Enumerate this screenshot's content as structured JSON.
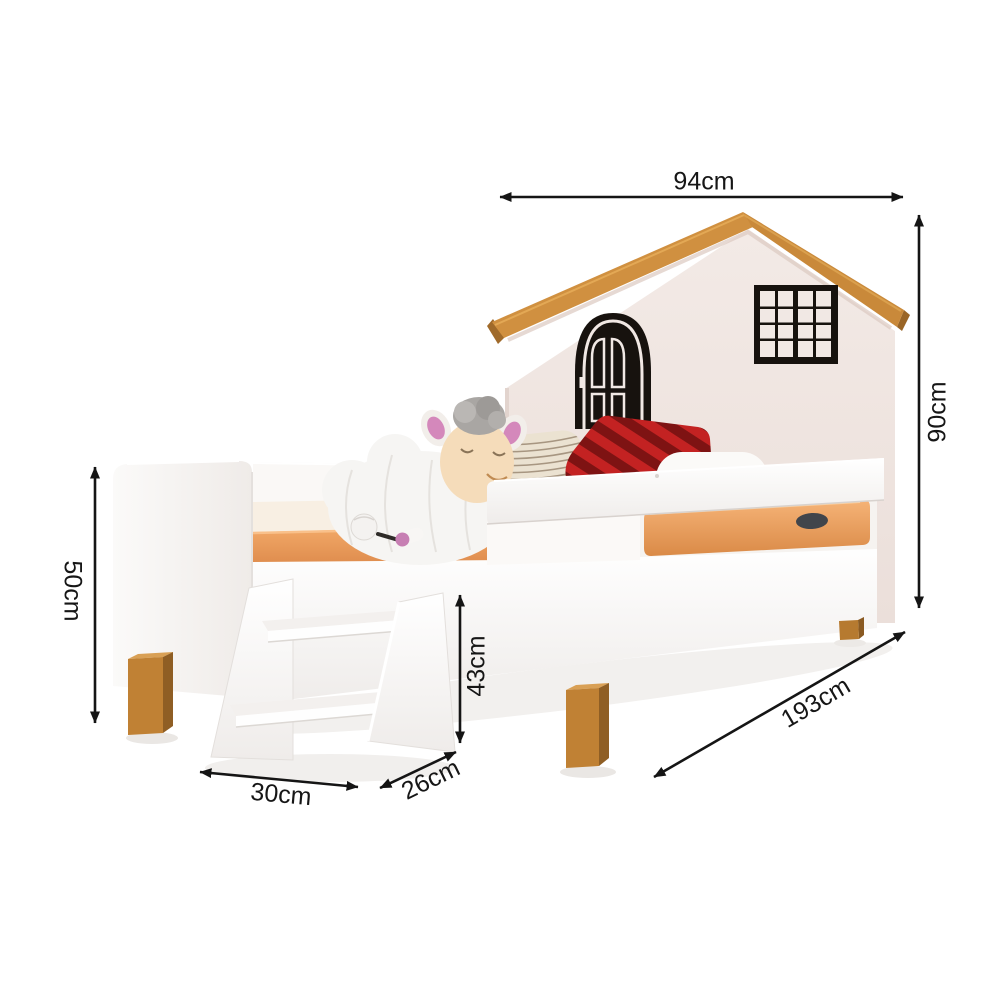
{
  "annotations": {
    "headboard_width": "94cm",
    "headboard_height": "90cm",
    "footboard_height": "50cm",
    "stool_height": "43cm",
    "stool_width": "30cm",
    "stool_depth": "26cm",
    "bed_length": "193cm"
  },
  "palette": {
    "background": "#ffffff",
    "arrow": "#151515",
    "roof_wood": "#d09040",
    "headboard_wall": "#f1e8e4",
    "decal_black": "#17120e",
    "bed_white": "#fdfcfb",
    "mattress_orange": "#eda266",
    "leg_wood": "#c08134",
    "pillow_red": "#c32222",
    "pillow_red_dark": "#7e1313",
    "pillow_knit": "#ebe2d1",
    "sheep_face": "#f5dcba"
  }
}
